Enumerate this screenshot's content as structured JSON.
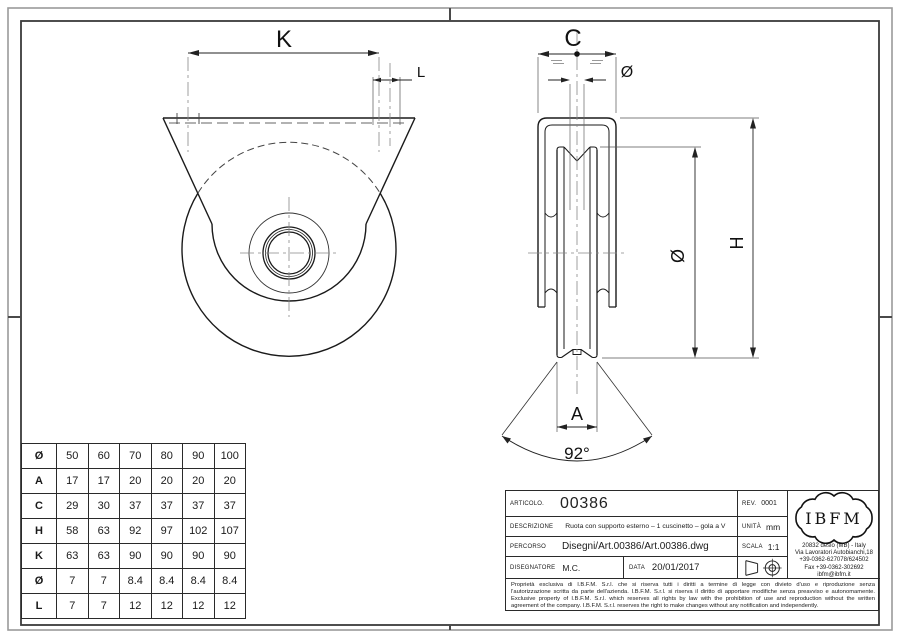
{
  "drawing": {
    "front_view": {
      "k": "K",
      "l": "L"
    },
    "side_view": {
      "c": "C",
      "hole_dia": "Ø",
      "outer_dia": "Ø",
      "h": "H",
      "a": "A",
      "groove_angle": "92°"
    }
  },
  "dim_table": {
    "rows": [
      {
        "label": "Ø",
        "values": [
          "50",
          "60",
          "70",
          "80",
          "90",
          "100"
        ]
      },
      {
        "label": "A",
        "values": [
          "17",
          "17",
          "20",
          "20",
          "20",
          "20"
        ]
      },
      {
        "label": "C",
        "values": [
          "29",
          "30",
          "37",
          "37",
          "37",
          "37"
        ]
      },
      {
        "label": "H",
        "values": [
          "58",
          "63",
          "92",
          "97",
          "102",
          "107"
        ]
      },
      {
        "label": "K",
        "values": [
          "63",
          "63",
          "90",
          "90",
          "90",
          "90"
        ]
      },
      {
        "label": "Ø",
        "values": [
          "7",
          "7",
          "8.4",
          "8.4",
          "8.4",
          "8.4"
        ]
      },
      {
        "label": "L",
        "values": [
          "7",
          "7",
          "12",
          "12",
          "12",
          "12"
        ]
      }
    ]
  },
  "title_block": {
    "articolo_label": "ARTICOLO.",
    "articolo_value": "00386",
    "rev_label": "REV.",
    "rev_value": "0001",
    "descrizione_label": "DESCRIZIONE",
    "descrizione_value": "Ruota con supporto esterno – 1 cuscinetto – gola a V",
    "unita_label": "UNITÀ",
    "unita_value": "mm",
    "percorso_label": "PERCORSO",
    "percorso_value": "Disegni/Art.00386/Art.00386.dwg",
    "scala_label": "SCALA",
    "scala_value": "1:1",
    "disegnatore_label": "DISEGNATORE",
    "disegnatore_value": "M.C.",
    "data_label": "DATA",
    "data_value": "20/01/2017",
    "logo_text": "IBFM",
    "address_lines": [
      "20832 desio (MB) - Italy",
      "Via Lavoratori Autobianchi,18",
      "+39-0362-627078/624502",
      "Fax +39-0362-302692",
      "ibfm@ibfm.it"
    ],
    "copyright_lines": [
      "Proprietà esclusiva di I.B.F.M. S.r.l. che si riserva tutti i diritti a termine di legge con divieto d'uso e riproduzione senza",
      "l'autorizzazione scritta da parte dell'azienda. I.B.F.M. S.r.l. si riserva il diritto di apportare modifiche senza preavviso e autonomamente.",
      "Exclusive property of I.B.F.M. S.r.l. which reserves all rights by law with the prohibition of use and reproduction without the written",
      "agreement of the company. I.B.F.M. S.r.l. reserves the right to make changes without any notification and independently."
    ]
  }
}
